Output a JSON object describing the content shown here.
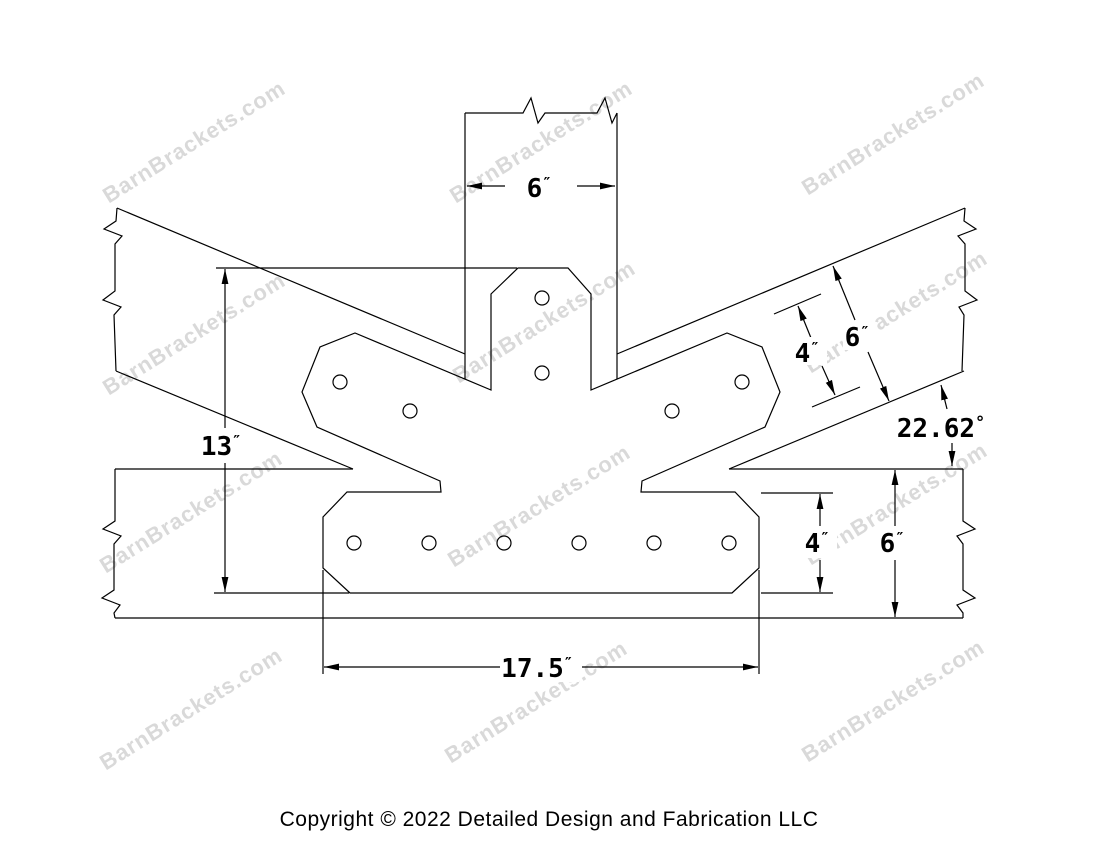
{
  "drawing": {
    "line_color": "#000000",
    "background_color": "#ffffff",
    "description": "Fan steel bracket for king post truss joint - dimensioned CAD drawing"
  },
  "watermark": {
    "text": "BarnBrackets.com",
    "color": "#d9d9d9"
  },
  "dimensions": {
    "post_width": {
      "value": "6",
      "unit": "″"
    },
    "bracket_height": {
      "value": "13",
      "unit": "″"
    },
    "strut_plate_width": {
      "value": "4",
      "unit": "″"
    },
    "strut_width": {
      "value": "6",
      "unit": "″"
    },
    "roof_angle": {
      "value": "22.62",
      "unit": "°"
    },
    "plate_height": {
      "value": "4",
      "unit": "″"
    },
    "beam_height": {
      "value": "6",
      "unit": "″"
    },
    "plate_length": {
      "value": "17.5",
      "unit": "″"
    }
  },
  "footer": {
    "copyright": "Copyright © 2022 Detailed Design and Fabrication LLC"
  }
}
